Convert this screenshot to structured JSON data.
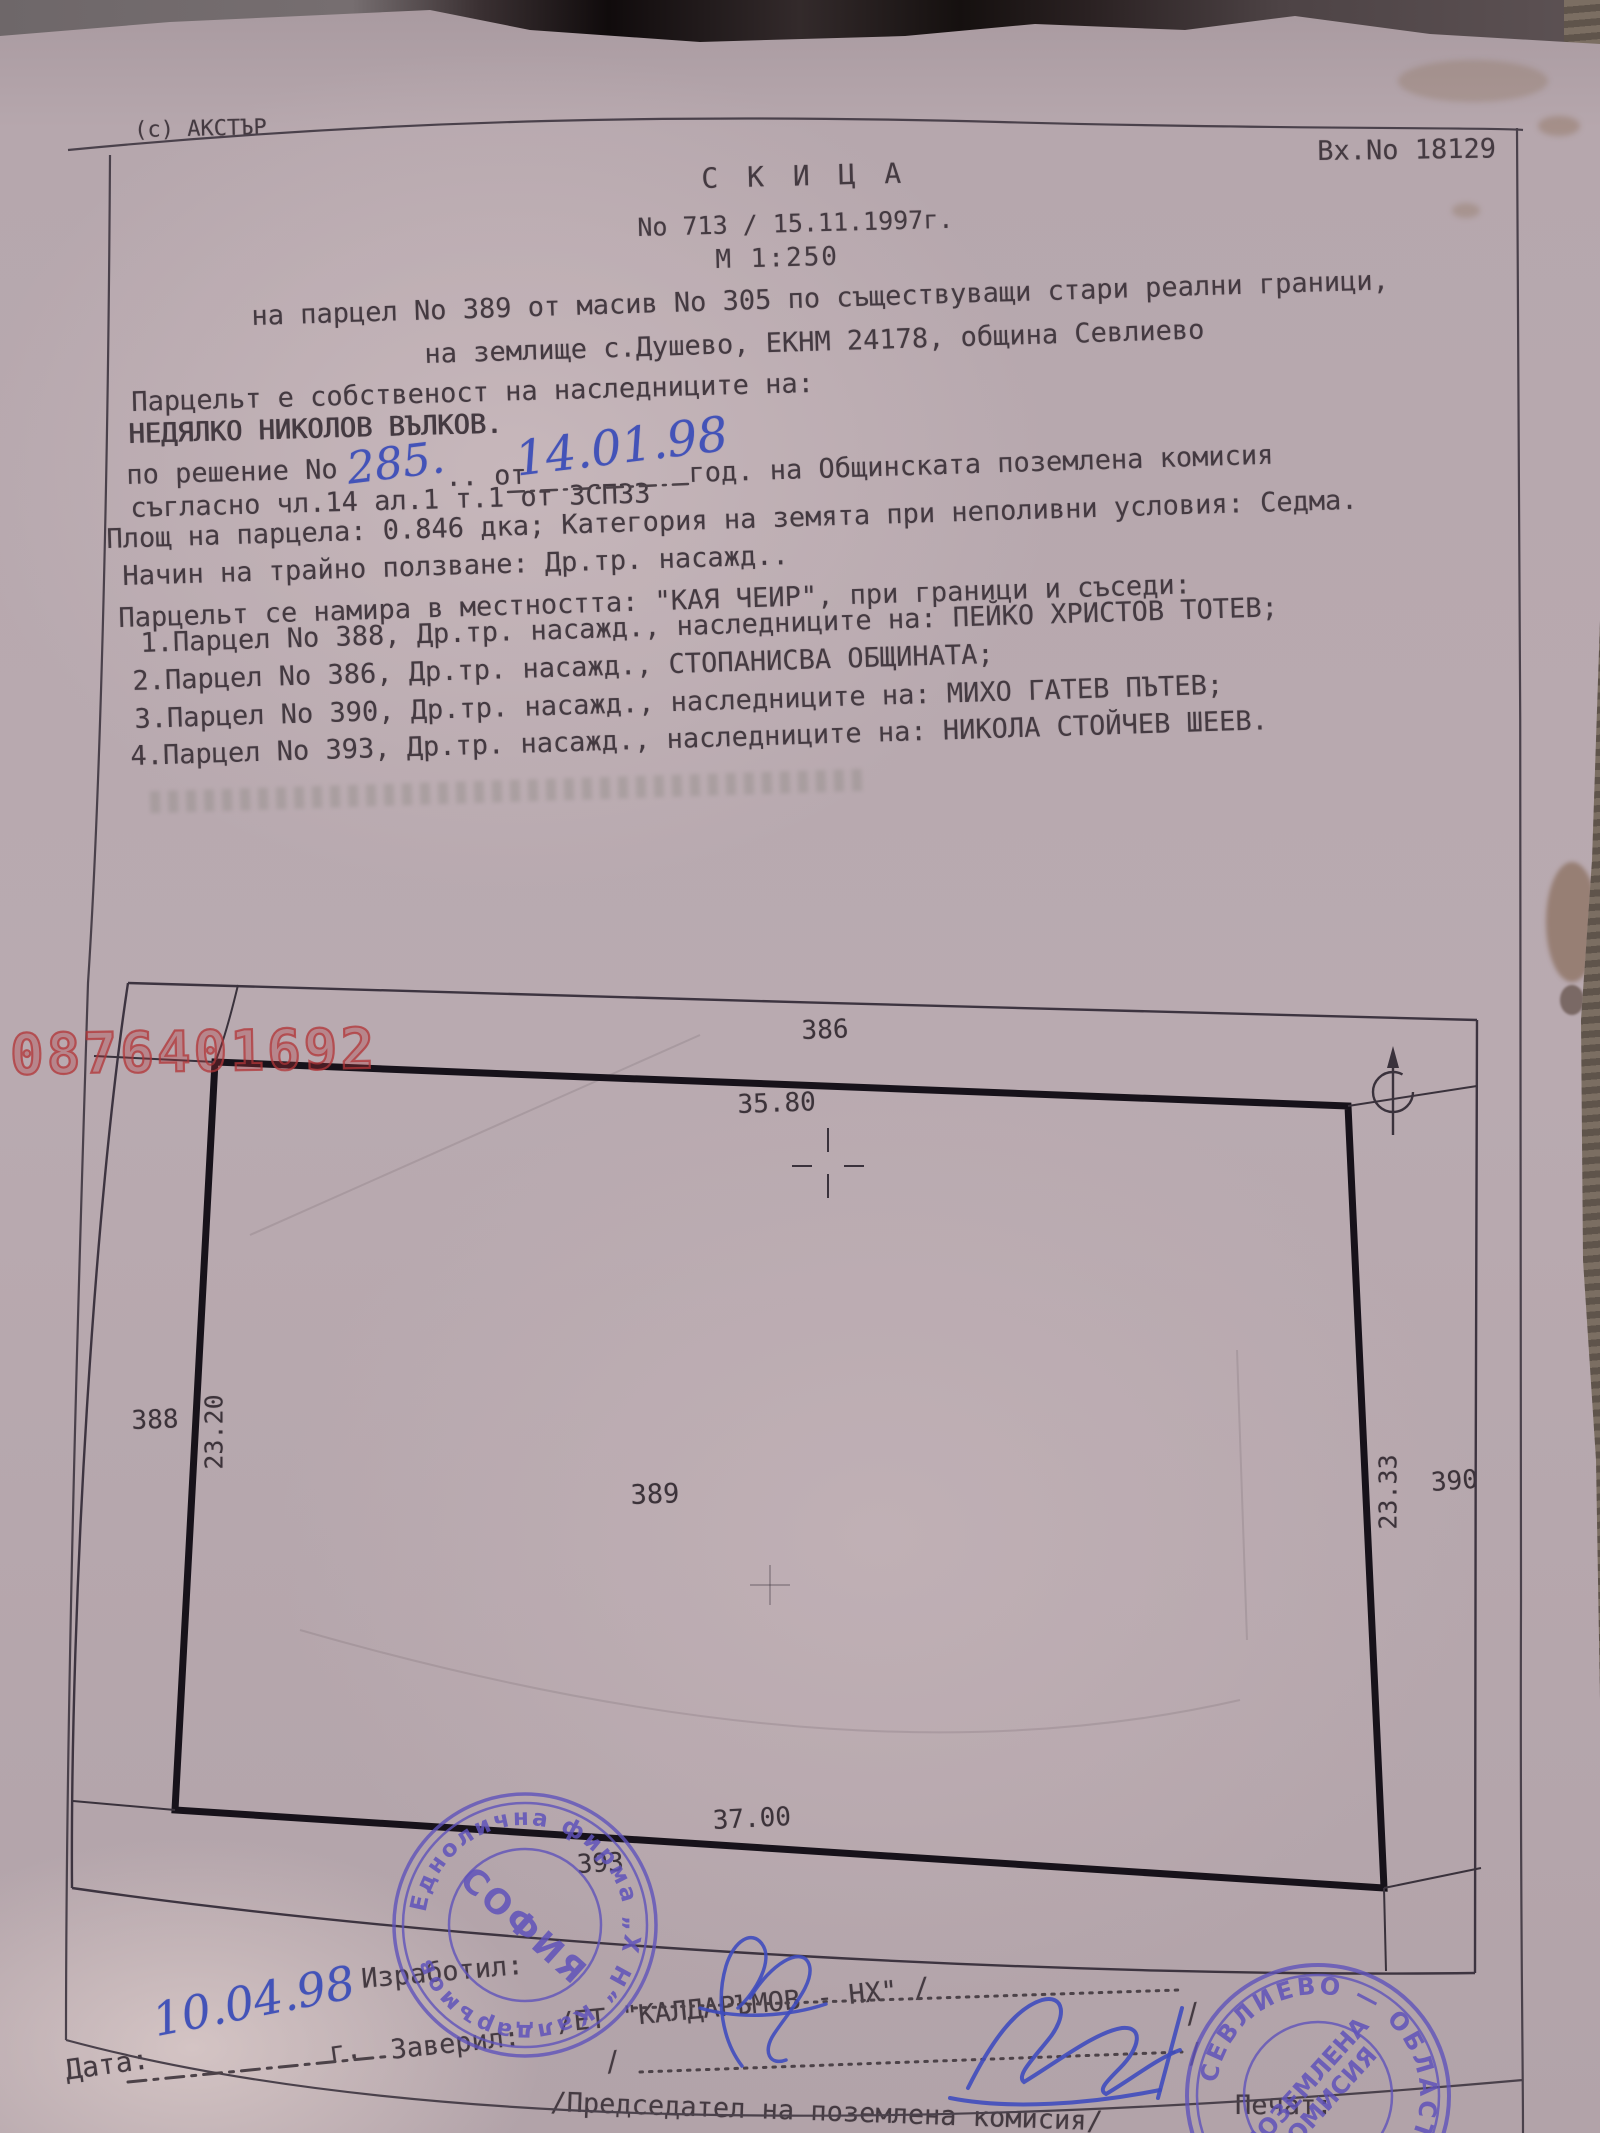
{
  "header": {
    "copyright": "(с) АКСТЪР",
    "entry_no": "Вх.No 18129",
    "title": "С К И Ц А",
    "number_line": "No 713 / 15.11.1997г.",
    "scale_line": "М 1:250"
  },
  "intro": {
    "line1": "на парцел No 389 от масив No 305 по съществуващи стари реални граници,",
    "line2": "на землище с.Душево, ЕКНМ 24178, община Севлиево"
  },
  "body": {
    "ownership_intro": "Парцельт е собственост на наследниците на:",
    "owner_name": "НЕДЯЛКО НИКОЛОВ ВЪЛКОВ.",
    "decision_prefix": "по решение No",
    "decision_no": "285.",
    "decision_mid": ".. от",
    "decision_date": "14.01.98",
    "decision_suffix": "год. на Общинската поземлена комисия",
    "legal_line": "съгласно чл.14 ал.1 т.1 от ЗСПЗЗ",
    "area_line": "Площ на парцела: 0.846 дка; Категория на земята при неполивни условия: Седма.",
    "usage_line": "Начин на трайно ползване: Др.тр. насажд..",
    "location_line": "Парцельт се намира в местността: \"КАЯ ЧЕИР\", при граници и съседи:",
    "neighbors": [
      "1.Парцел No 388, Др.тр. насажд., наследниците на: ПЕЙКО ХРИСТОВ ТОТЕВ;",
      "2.Парцел No 386, Др.тр. насажд., СТОПАНИСВА ОБЩИНАТА;",
      "3.Парцел No 390, Др.тр. насажд., наследниците на: МИХО ГАТЕВ ПЪТЕВ;",
      "4.Парцел No 393, Др.тр. насажд., наследниците на: НИКОЛА СТОЙЧЕВ ШЕЕВ."
    ]
  },
  "drawing": {
    "north_parcel": "386",
    "north_dim": "35.80",
    "west_parcel": "388",
    "west_dim": "23.20",
    "parcel_no": "389",
    "east_dim": "23.33",
    "east_parcel": "390",
    "south_dim": "37.00",
    "south_parcel": "393"
  },
  "watermark": "0876401692",
  "footer": {
    "prepared_label": "Изработил:",
    "company_line": "/ЕТ \"КАЛДАРЪМОВ - НХ\" /",
    "certified_label": "Заверил:",
    "chairman_line": "/Председател на поземлена комисия/",
    "seal_label": "Печат:",
    "date_label": "Дата:",
    "date_value": "10.04.98",
    "date_suffix": "г.",
    "slash": "/"
  },
  "stamps": {
    "left": {
      "ring_text": "Еднолична фирма „Х Н“ Калдаръмов",
      "center_text": "СОФИЯ"
    },
    "right": {
      "ring_text": "СЕВЛИЕВО — ОБЛАСТ —",
      "inner_line1": "ПОЗЕМЛЕНА",
      "inner_line2": "КОМИСИЯ"
    }
  },
  "colors": {
    "paper": "#b6a7ad",
    "ink": "#443a41",
    "watermark_red": "#b23538",
    "stamp_purple": "#5c50b4",
    "ink_blue": "#4353b8"
  }
}
